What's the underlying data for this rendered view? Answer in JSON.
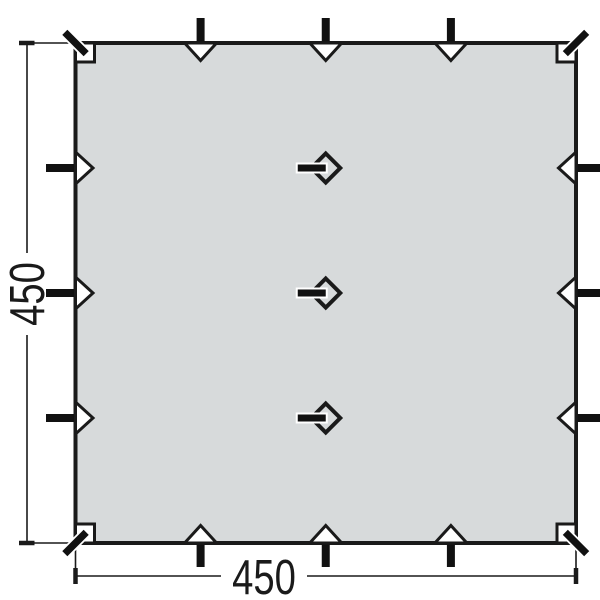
{
  "title": "Tarp top-view dimension diagram",
  "dimensions": {
    "width_label": "450",
    "height_label": "450"
  },
  "colors": {
    "fabric": "#d7dadb",
    "line": "#1a1a1a",
    "tab": "#111111",
    "background": "#ffffff"
  },
  "features": {
    "corner_straps": 4,
    "corner_reinforcement_patches": 4,
    "edge_loops_per_side": 3,
    "edge_loop_sides": [
      "top",
      "right",
      "bottom",
      "left"
    ],
    "center_attachment_points": 3
  }
}
